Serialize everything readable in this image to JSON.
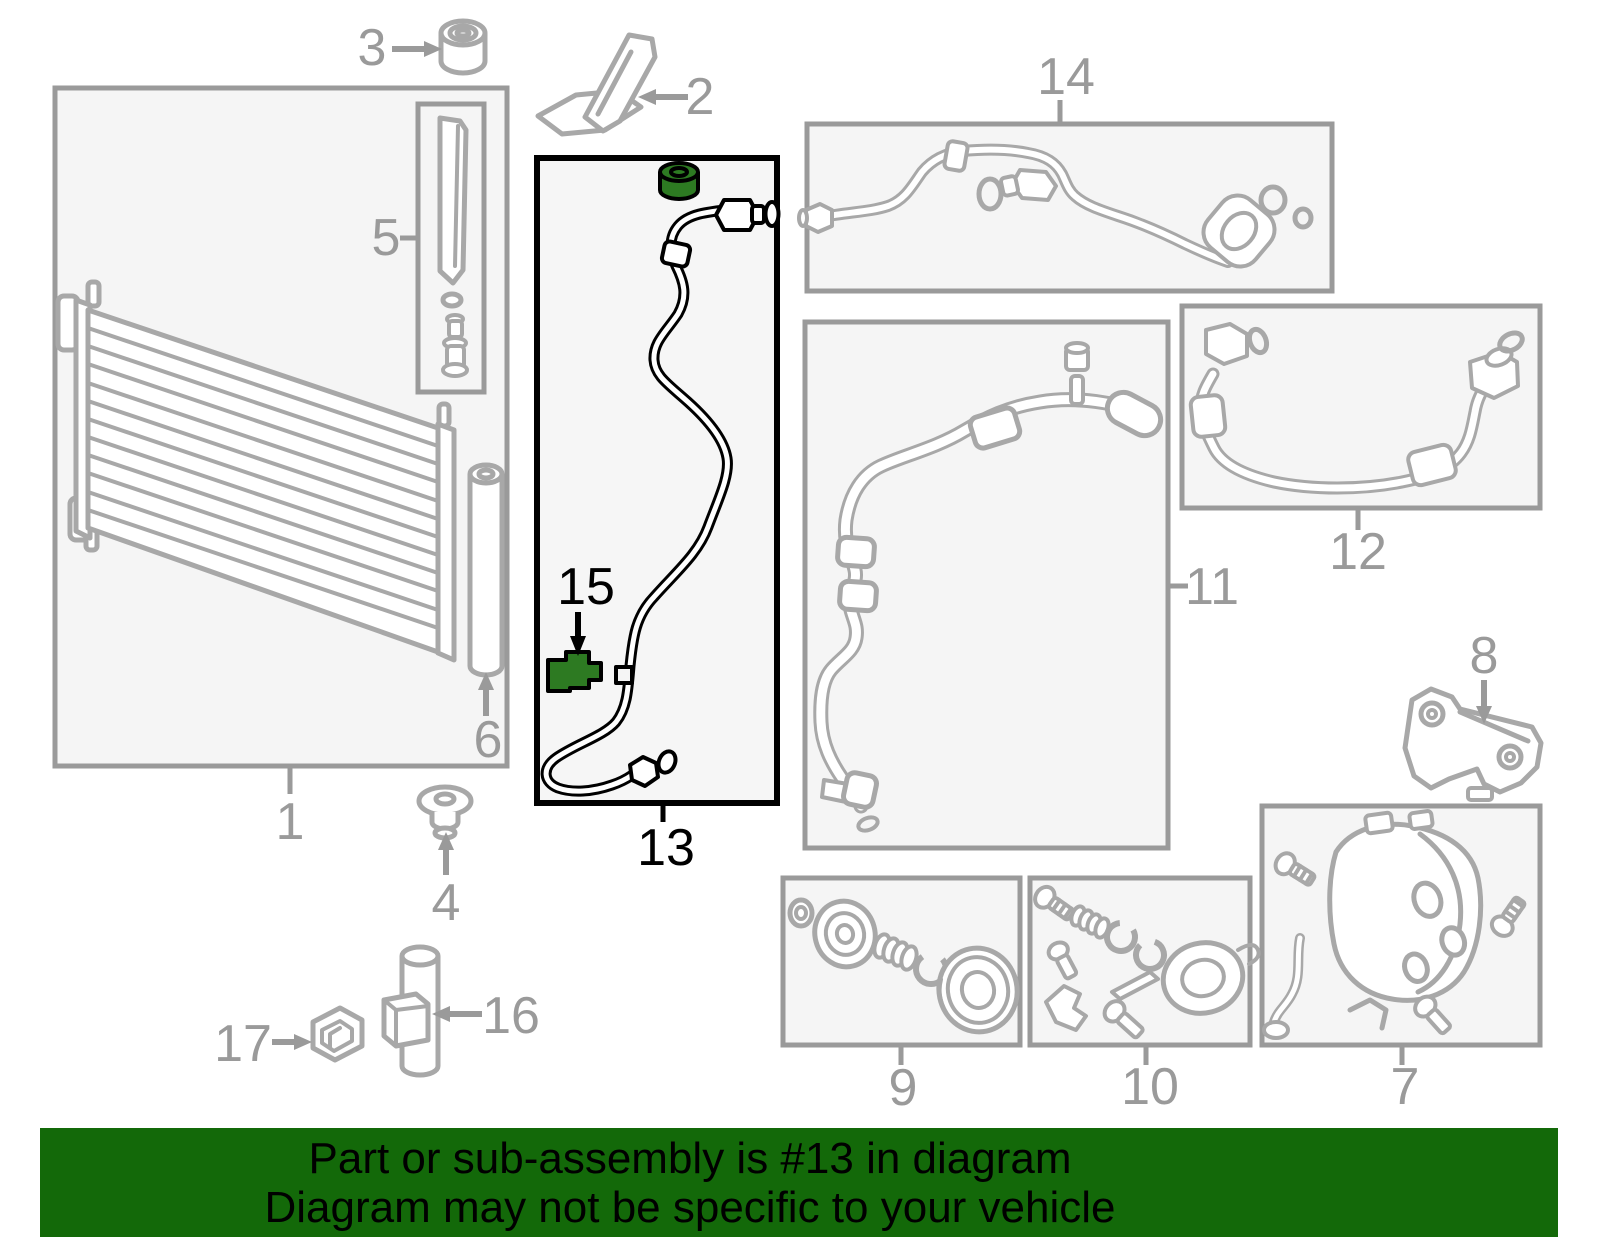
{
  "banner": {
    "line1": "Part or sub-assembly is #13 in diagram",
    "line2": "Diagram may not be specific to your vehicle"
  },
  "highlighted_part_number": "13",
  "colors": {
    "banner_bg": "#136909",
    "banner_text": "#000000",
    "highlight_green": "#2d7a22",
    "highlight_outline": "#000000",
    "diagram_line_gray": "#a8a8a8",
    "box_border_gray": "#9a9a9a",
    "box_fill": "#f5f5f5",
    "page_bg": "#ffffff"
  },
  "parts": {
    "p1": {
      "label": "1"
    },
    "p2": {
      "label": "2"
    },
    "p3": {
      "label": "3"
    },
    "p4": {
      "label": "4"
    },
    "p5": {
      "label": "5"
    },
    "p6": {
      "label": "6"
    },
    "p7": {
      "label": "7"
    },
    "p8": {
      "label": "8"
    },
    "p9": {
      "label": "9"
    },
    "p10": {
      "label": "10"
    },
    "p11": {
      "label": "11"
    },
    "p12": {
      "label": "12"
    },
    "p13": {
      "label": "13"
    },
    "p14": {
      "label": "14"
    },
    "p15": {
      "label": "15"
    },
    "p16": {
      "label": "16"
    },
    "p17": {
      "label": "17"
    }
  }
}
